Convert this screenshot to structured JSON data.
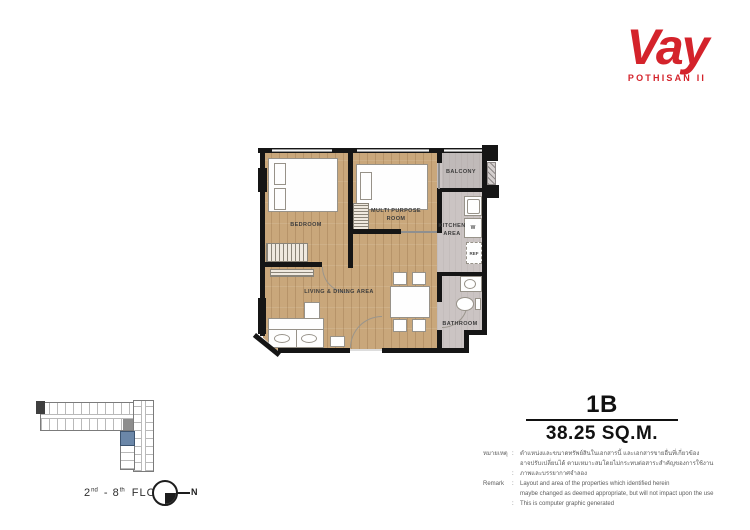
{
  "logo": {
    "brand": "Vay",
    "subtitle": "POTHISAN II",
    "color": "#d4232b"
  },
  "unit": {
    "type": "1B",
    "area": "38.25 SQ.M."
  },
  "plan": {
    "rooms": {
      "bedroom": "BEDROOM",
      "multi_purpose_1": "MULTI PURPOSE",
      "multi_purpose_2": "ROOM",
      "living": "LIVING & DINING AREA",
      "balcony": "BALCONY",
      "kitchen_1": "KITCHEN",
      "kitchen_2": "AREA",
      "bathroom": "BATHROOM"
    },
    "fixtures": {
      "washer": "W",
      "fridge": "REF"
    }
  },
  "keyplan": {
    "floor_from": "2",
    "floor_from_sup": "nd",
    "floor_mid": "- 8",
    "floor_to_sup": "th",
    "floor_word": "FLOOR",
    "north": "N"
  },
  "remarks": {
    "colon": ":",
    "th_label": "หมายเหตุ",
    "th_line1": "ตำแหน่งและขนาดทรัพย์สินในเอกสารนี้ และเอกสารขายอื่นที่เกี่ยวข้อง",
    "th_line2": "อาจปรับเปลี่ยนได้ ตามเหมาะสมโดยไม่กระทบต่อสาระสำคัญของการใช้งาน",
    "th_line3": "ภาพและบรรยากาศจำลอง",
    "en_label": "Remark",
    "en_line1": "Layout and area of the properties which identified herein",
    "en_line2": "maybe changed as deemed appropriate, but will not impact upon the use",
    "en_line3": "This is computer graphic generated"
  }
}
